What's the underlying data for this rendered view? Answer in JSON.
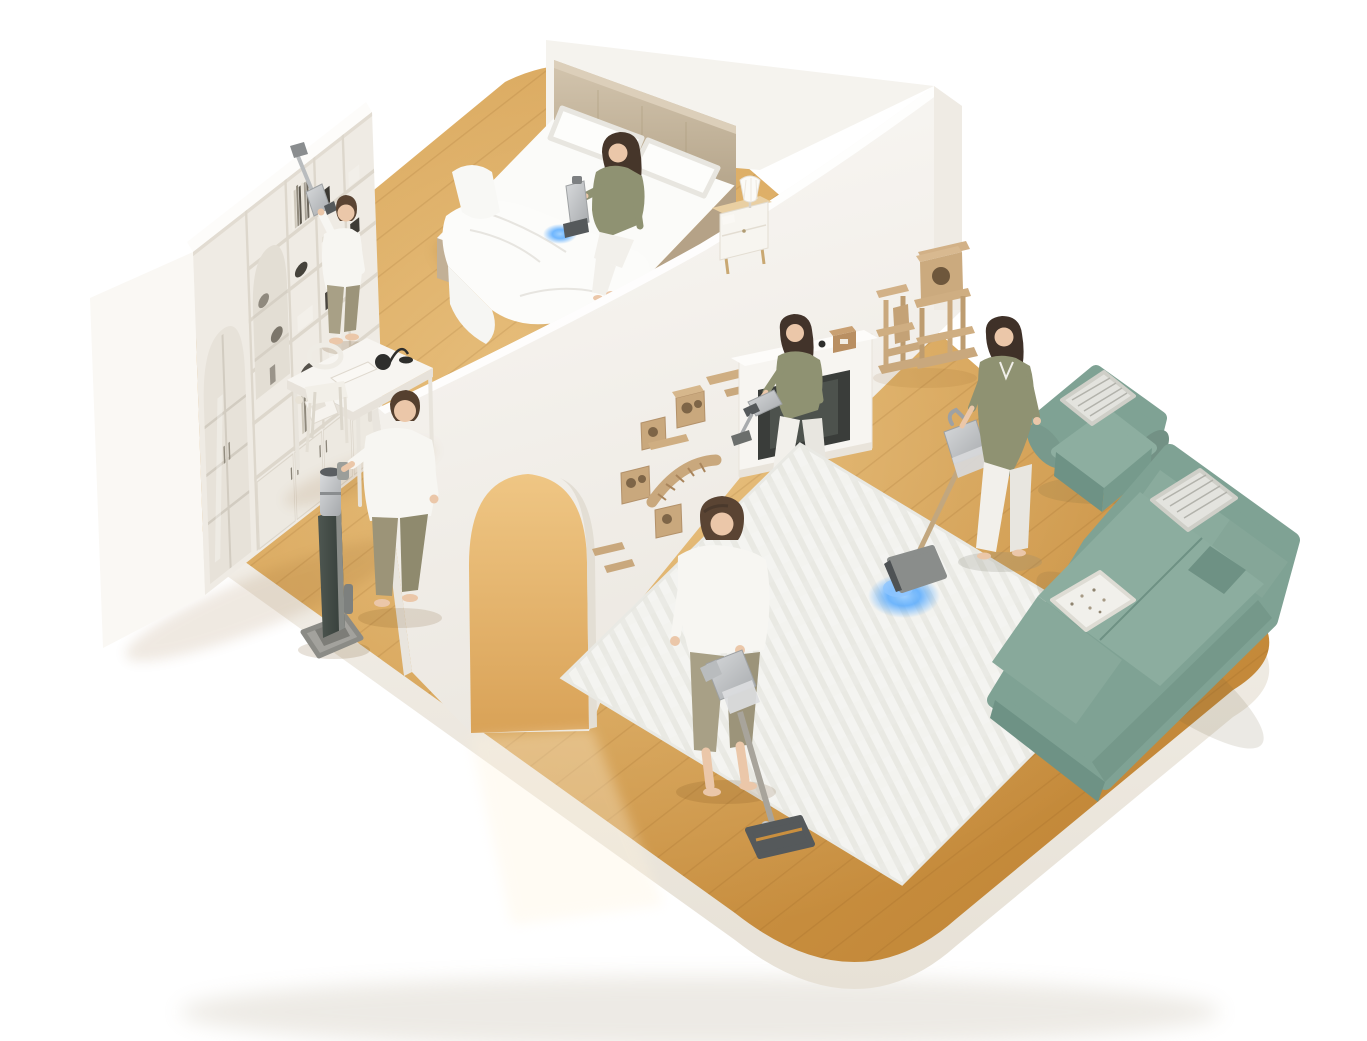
{
  "scene": {
    "title": "Isometric cutaway home illustration with five people cleaning using cordless vacuums",
    "style": "3D isometric dollhouse product render on white background",
    "background_color": "#ffffff",
    "platform": {
      "shape": "rounded-square floating slab",
      "floor_material": "light oak plank flooring",
      "floor_color": "#D29A4C",
      "floor_highlight": "#F0CC92",
      "base_color": "#F6F3ED"
    },
    "rooms": [
      {
        "name": "bedroom",
        "position": "top-left",
        "items": [
          "white shelving wall unit with arched fluted-glass doors",
          "double bed with beige tufted headboard and white bedding",
          "wooden nightstand with white pleated table lamp",
          "white writing desk",
          "white chair",
          "black desk lamp",
          "white laptop",
          "white countertop appliance"
        ]
      },
      {
        "name": "hallway",
        "position": "center",
        "items": [
          "white partition wall with arched doorway",
          "dark grey vacuum charging dock tower"
        ]
      },
      {
        "name": "living-room",
        "position": "right",
        "items": [
          "teal fabric armchair with striped cushion",
          "teal sectional sofa with chaise",
          "white herringbone area rug",
          "white fireplace console with dark firebox",
          "wall-mounted wooden cat shelves and climbing bridge",
          "two beige cat trees",
          "cat food bowl"
        ]
      }
    ],
    "people": [
      {
        "id": "man-bookshelf",
        "activity": "Dusting the top shelf with an extended vacuum wand",
        "clothing": "white t-shirt, beige trousers",
        "location": "bedroom bookshelf"
      },
      {
        "id": "woman-bed",
        "activity": "Vacuuming the mattress with a handheld vacuum",
        "clothing": "olive top, white trousers",
        "location": "sitting on the bed edge",
        "effect": "blue suction glow on mattress"
      },
      {
        "id": "man-dock",
        "activity": "Placing a cordless vacuum on its charging dock",
        "clothing": "white t-shirt, olive trousers",
        "location": "beside the desk"
      },
      {
        "id": "woman-cat-wall",
        "activity": "Cleaning wall-mounted cat shelves with a handheld vacuum",
        "clothing": "olive top, white trousers",
        "location": "living room near fireplace"
      },
      {
        "id": "woman-rug",
        "activity": "Vacuuming the rug with a cordless stick vacuum",
        "clothing": "olive cardigan, white trousers",
        "location": "living room rug",
        "effect": "blue headlight glow on rug"
      },
      {
        "id": "man-floor",
        "activity": "Vacuuming the wood floor with a cordless stick vacuum",
        "clothing": "white t-shirt, beige trousers",
        "location": "center hallway"
      }
    ],
    "products": {
      "stick_vacuums": 2,
      "handheld_vacuums": 3,
      "charging_docks": 1,
      "body_color": "silver-grey",
      "glow_accent": "#4EA6FF"
    },
    "palette": {
      "wood": "#D29A4C",
      "wood_highlight": "#F0CC92",
      "platform_base": "#F6F3ED",
      "wall": "#F5F3EE",
      "shelving": "#EFEBE4",
      "headboard": "#C8BAA3",
      "bedding": "#FBFBF8",
      "sofa": "#84A698",
      "rug": "#F4F4F1",
      "cat_wood": "#C9A87D",
      "fireplace": "#F7F5F1",
      "glow_blue": "#4EA6FF",
      "vacuum_silver": "#C6C8CA",
      "vacuum_dark": "#4E5254",
      "dock_dark": "#46504B",
      "skin": "#EBC7A9",
      "hair": "#4A392C",
      "shirt_white": "#F7F6F2",
      "shirt_olive": "#8F9272",
      "pants_khaki": "#A8A086",
      "pants_white": "#F2F0EB"
    }
  }
}
